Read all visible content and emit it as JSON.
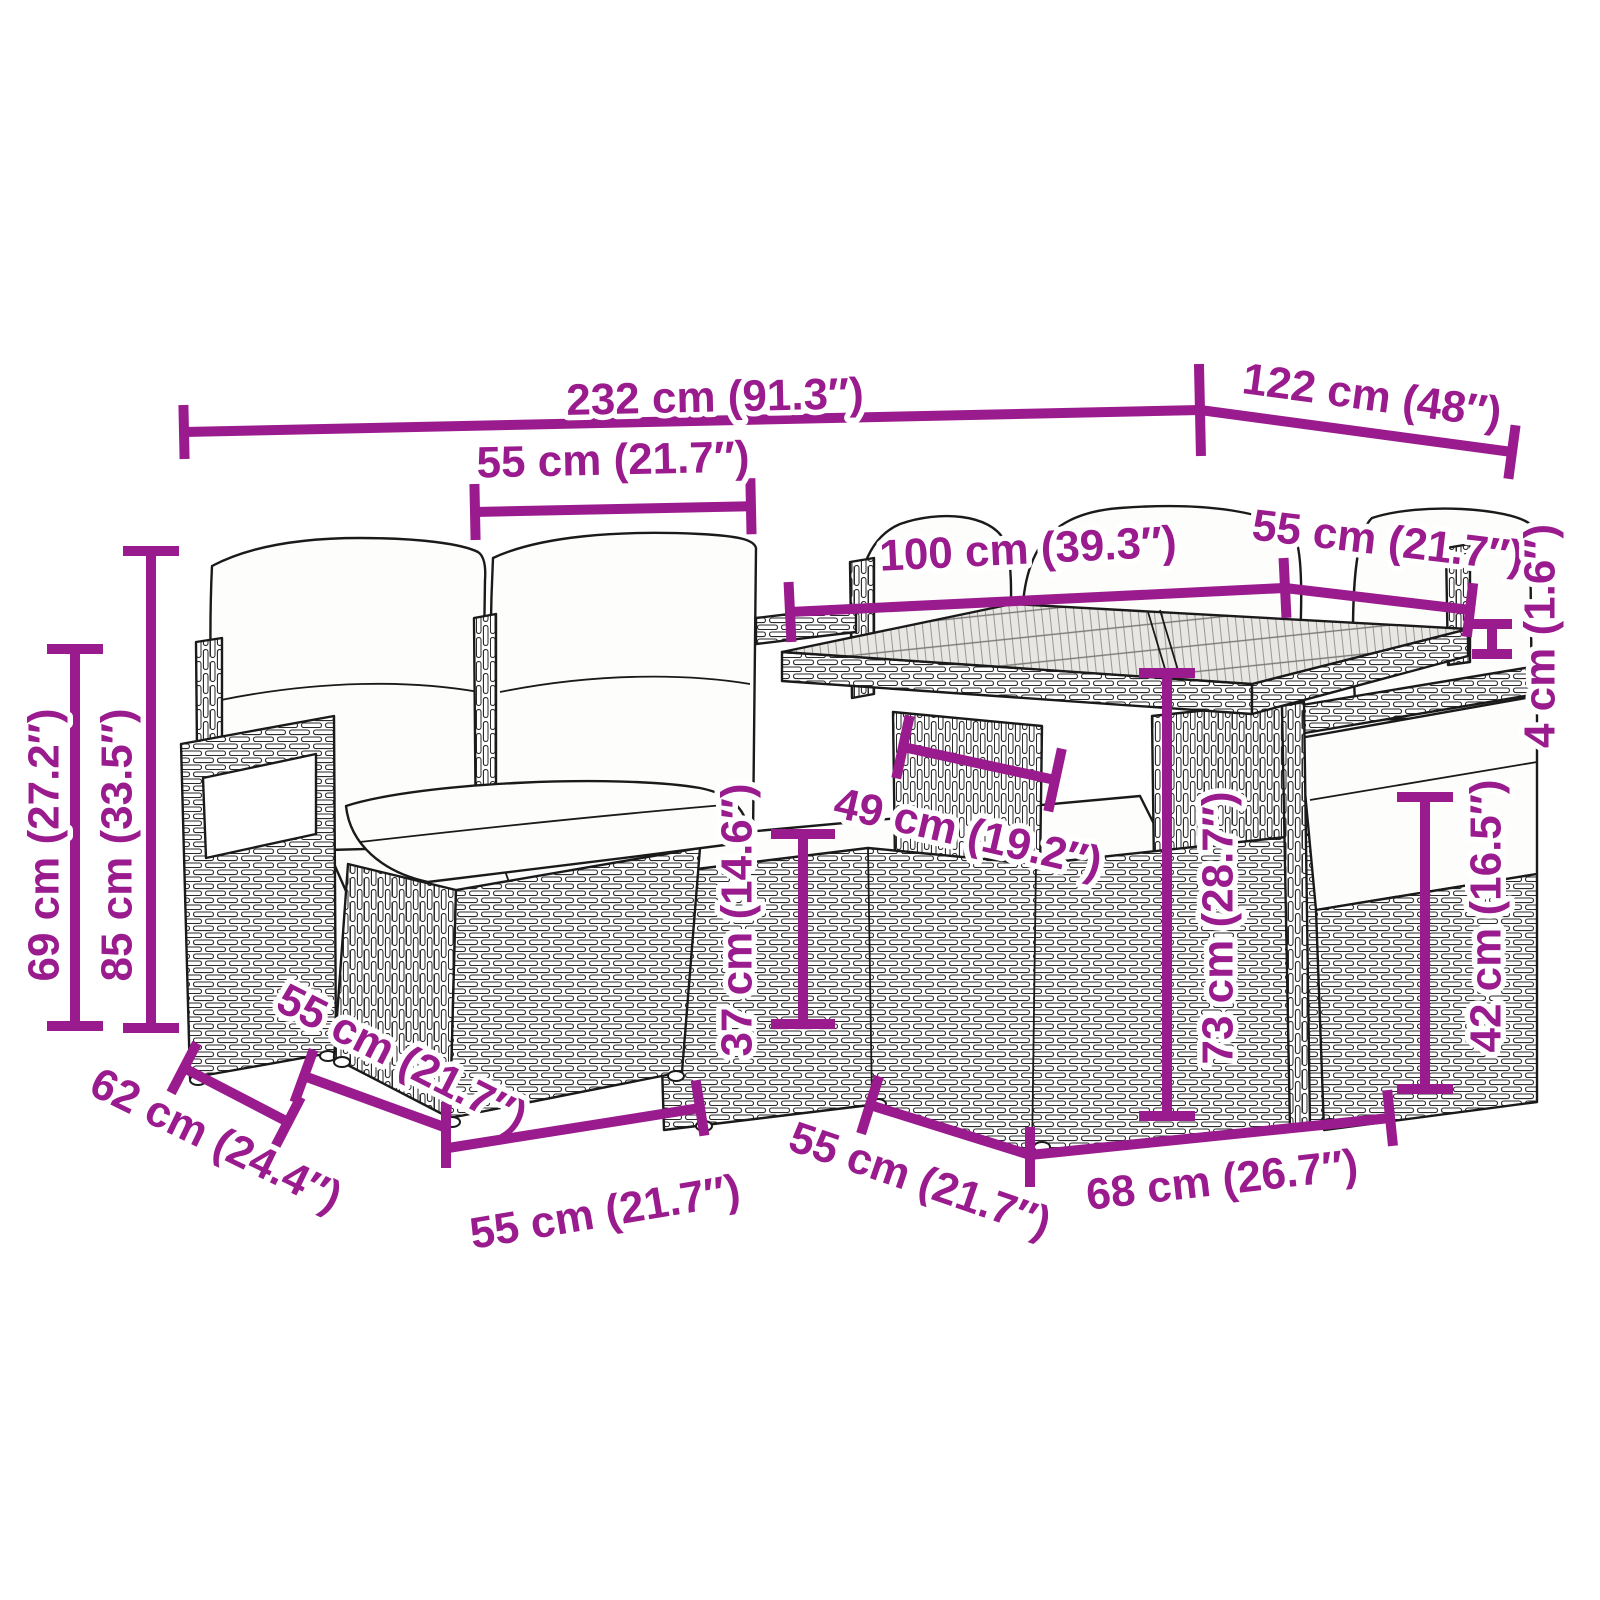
{
  "figure": {
    "name": "garden-sofa-set-dimension-diagram",
    "subject": "poly-rattan garden lounge set with cushions, ottoman and table",
    "background_color": "#ffffff",
    "dimension_color": "#9A1B8D",
    "artwork_color": "#1a1a1a",
    "dimensions": [
      {
        "id": "overall-width",
        "label": "232 cm (91.3″)"
      },
      {
        "id": "overall-depth",
        "label": "122 cm (48″)"
      },
      {
        "id": "back-cushion-width",
        "label": "55 cm (21.7″)"
      },
      {
        "id": "table-length",
        "label": "100 cm (39.3″)"
      },
      {
        "id": "table-depth",
        "label": "55 cm (21.7″)"
      },
      {
        "id": "tabletop-thickness",
        "label": "4 cm (1.6″)"
      },
      {
        "id": "backrest-height",
        "label": "85 cm (33.5″)"
      },
      {
        "id": "arm-height",
        "label": "69 cm (27.2″)"
      },
      {
        "id": "pedestal-width",
        "label": "49 cm (19.2″)"
      },
      {
        "id": "table-height",
        "label": "73 cm (28.7″)"
      },
      {
        "id": "ottoman-height",
        "label": "37 cm (14.6″)"
      },
      {
        "id": "seat-height",
        "label": "42 cm (16.5″)"
      },
      {
        "id": "seat-depth",
        "label": "62 cm (24.4″)"
      },
      {
        "id": "ottoman-depth",
        "label": "55 cm (21.7″)"
      },
      {
        "id": "ottoman-width",
        "label": "55 cm (21.7″)"
      },
      {
        "id": "seat-width",
        "label": "55 cm (21.7″)"
      },
      {
        "id": "table-base-width",
        "label": "68 cm (26.7″)"
      }
    ]
  }
}
